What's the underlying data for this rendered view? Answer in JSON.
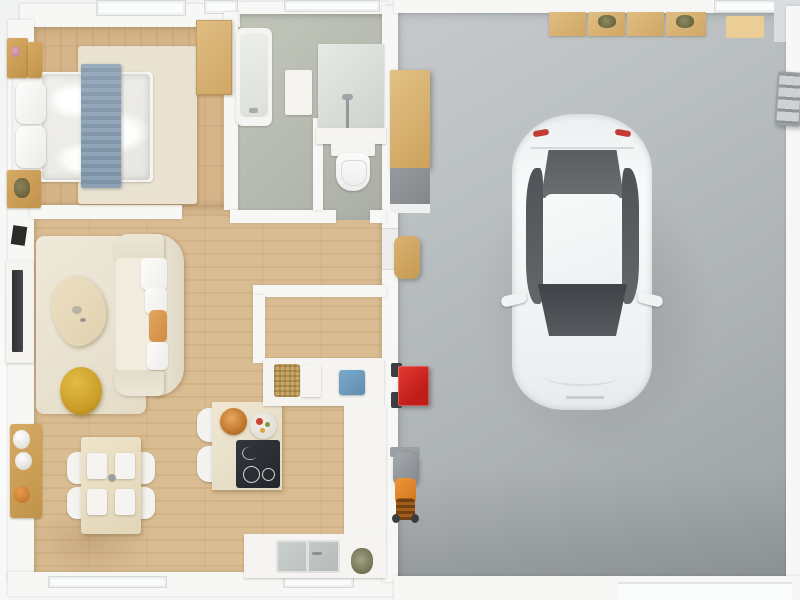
{
  "meta": {
    "image_kind": "3d-floor-plan-render-top-down",
    "width_px": 800,
    "height_px": 600,
    "visible_text": "none"
  },
  "palette": {
    "exterior": "#f4f5f5",
    "wall_white": "#f7f7f5",
    "wood_floor": "#d8b88c",
    "bathroom_floor": "#b6bab0",
    "garage_floor": "#adb2b5",
    "rug_cream": "#e9e2d0",
    "gold_wood": "#c9a05a",
    "cabinet_wood": "#d7ae62",
    "blanket_blue": "#8ba0b3",
    "pouf_yellow": "#d0a52f",
    "cushion_orange": "#dc9b54",
    "cart_red": "#d12420",
    "mower_orange": "#e08426",
    "towel_blue": "#6d9cbe",
    "cooktop_black": "#2c2f34",
    "car_body": "#f2f4f5",
    "car_glass": "#53585c",
    "car_taillight_red": "#c43b36"
  },
  "rooms": [
    {
      "id": "bedroom",
      "position": "top-left",
      "floor": "wood",
      "furniture": [
        "double-bed-white-duvet",
        "blue-runner-blanket",
        "two-pillows",
        "nightstand-with-flowers",
        "second-nightstand",
        "dresser-with-plant",
        "wardrobe",
        "cream-area-rug"
      ]
    },
    {
      "id": "bathroom",
      "position": "top-center",
      "floor": "sage-tile",
      "furniture": [
        "bathtub",
        "vanity-with-faucet",
        "toilet",
        "bath-mat"
      ]
    },
    {
      "id": "living-room",
      "position": "mid-left",
      "floor": "wood",
      "furniture": [
        "cream-sofa-facing-left",
        "orange-cushion",
        "white-seat-cushions",
        "organic-coffee-table",
        "yellow-pouf",
        "tv-console",
        "wall-mounted-tv",
        "black-wall-art",
        "cream-rug"
      ]
    },
    {
      "id": "dining-area",
      "position": "bottom-left",
      "floor": "wood",
      "furniture": [
        "dining-table",
        "four-white-chairs",
        "four-white-placemats",
        "gold-sideboard",
        "two-white-decor-spheres",
        "orange-decor-bowl"
      ]
    },
    {
      "id": "kitchen",
      "position": "bottom-center",
      "floor": "wood",
      "furniture": [
        "island-with-induction-cooktop",
        "orange-food-bowl",
        "vegetable-plate",
        "two-island-chairs",
        "mid-counter-with-wicker-basket-white-box-blue-towel",
        "right-counter",
        "bottom-counter-with-double-sink",
        "potted-plant"
      ]
    },
    {
      "id": "hallway",
      "position": "center",
      "floor": "wood",
      "furniture": []
    },
    {
      "id": "garage",
      "position": "right-half",
      "floor": "concrete-gray",
      "furniture": [
        "white-car-top-view",
        "four-wall-cabinets",
        "two-cabinet-plants",
        "wooden-workbench-gray-base",
        "wooden-step-stool",
        "red-tool-cart",
        "lawn-mower",
        "metal-ladder",
        "tan-floor-mat",
        "garage-door-bottom",
        "top-wall-window"
      ]
    }
  ],
  "car": {
    "color": "white",
    "orientation": "rear-at-top-front-at-bottom",
    "details": [
      "dark-rear-window",
      "white-roof",
      "dark-windshield",
      "dark-side-windows",
      "two-side-mirrors",
      "red-taillights"
    ]
  },
  "counts": {
    "garage_wall_cabinets": 4,
    "dining_chairs": 4,
    "dining_placemats": 4,
    "island_chairs": 2,
    "bed_pillows": 2,
    "cooktop_burners": 2
  }
}
